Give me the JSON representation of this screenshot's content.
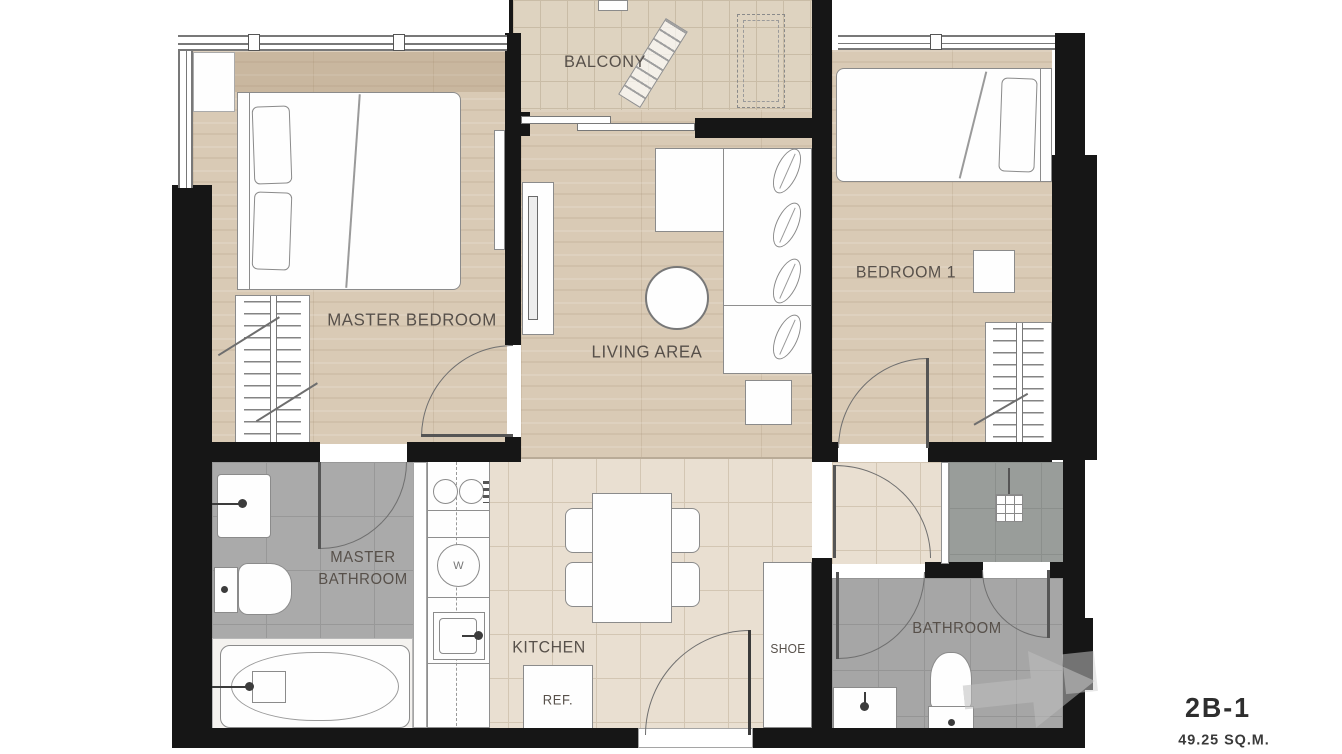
{
  "unit": {
    "name": "2B-1",
    "area": "49.25 SQ.M."
  },
  "rooms": {
    "balcony": "BALCONY",
    "master_bedroom": "MASTER BEDROOM",
    "living_area": "LIVING AREA",
    "bedroom1": "BEDROOM 1",
    "master_bathroom_line1": "MASTER",
    "master_bathroom_line2": "BATHROOM",
    "kitchen": "KITCHEN",
    "bathroom": "BATHROOM"
  },
  "fixtures": {
    "refrigerator": "REF.",
    "shoe_cabinet": "SHOE",
    "washer": "W"
  },
  "colors": {
    "wall": "#161616",
    "wood_floor": "#d9cab5",
    "balcony_tile": "#ded3c0",
    "kitchen_tile": "#e9dfd1",
    "bathroom_gray": "#a6a6a6",
    "shower_gray": "#999d9a",
    "label_text": "#57504a",
    "unit_text": "#2e2e2e"
  }
}
